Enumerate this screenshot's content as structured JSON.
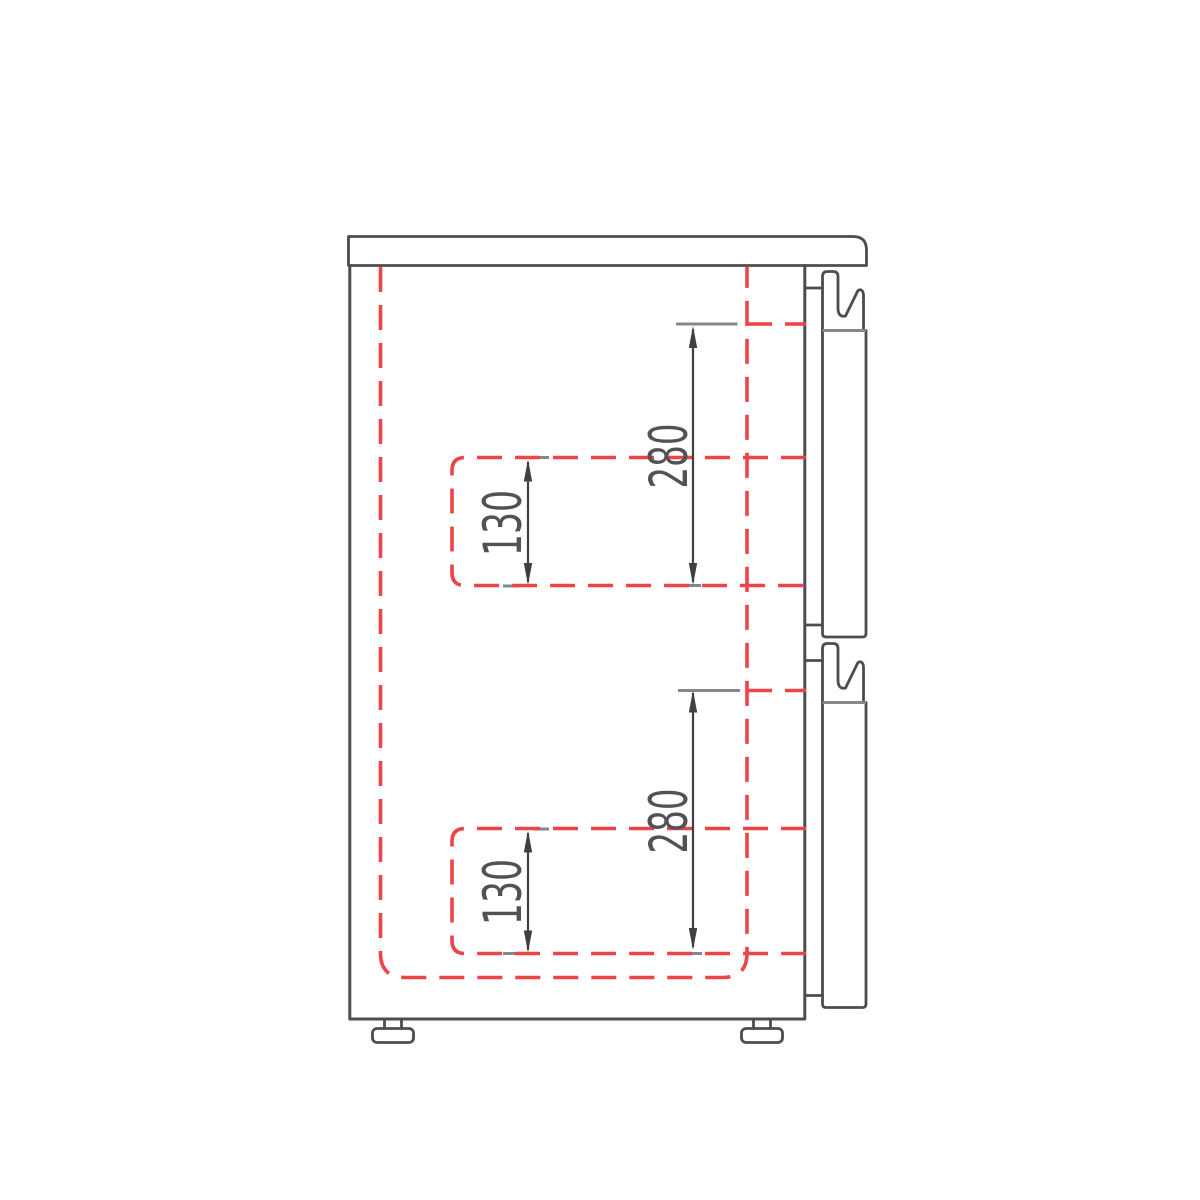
{
  "drawing": {
    "title": "two-drawer cabinet side-section technical drawing",
    "labels": {
      "dim_280_top": "280",
      "dim_130_top": "130",
      "dim_280_bottom": "280",
      "dim_130_bottom": "130"
    }
  },
  "colors": {
    "background": "#ffffff",
    "outline": "#4b4d4f",
    "red_dashed": "#ee4448",
    "gray_line": "#85878a",
    "dimension": "#3f4043",
    "text": "#515254"
  }
}
